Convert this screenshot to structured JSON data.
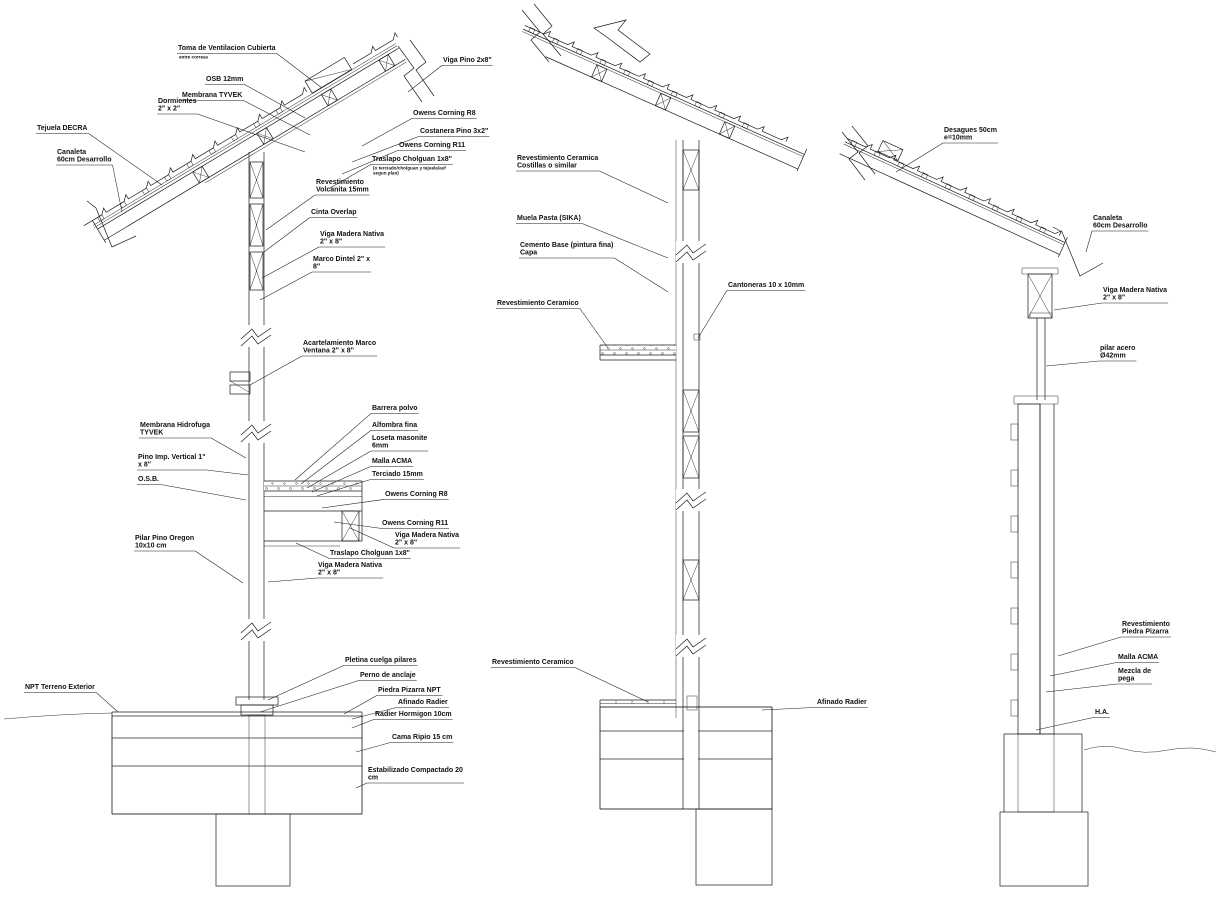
{
  "drawing": {
    "type": "cad-construction-section-details",
    "background_color": "#ffffff",
    "line_color": "#1b1b1b",
    "sections": [
      "left-wall-roof-section",
      "middle-wall-section",
      "right-pillar-section"
    ]
  },
  "annotations": {
    "left_section": [
      {
        "name": "toma-ventilacion-cubierta",
        "lines": [
          "Toma de Ventilacion Cubierta"
        ],
        "sub": [
          "entre correas"
        ],
        "x": 178,
        "y": 50,
        "tx": 322,
        "ty": 88
      },
      {
        "name": "osb-12mm",
        "lines": [
          "OSB 12mm"
        ],
        "x": 206,
        "y": 81,
        "tx": 305,
        "ty": 118
      },
      {
        "name": "membrana-tyvek",
        "lines": [
          "Membrana TYVEK"
        ],
        "x": 182,
        "y": 97,
        "tx": 310,
        "ty": 135
      },
      {
        "name": "dormientes-2x2",
        "lines": [
          "Dormientes",
          "2\" x 2\""
        ],
        "x": 158,
        "y": 103,
        "tx": 305,
        "ty": 152
      },
      {
        "name": "tejuela-decra",
        "lines": [
          "Tejuela DECRA"
        ],
        "x": 37,
        "y": 130,
        "tx": 162,
        "ty": 185
      },
      {
        "name": "canaleta-60cm",
        "lines": [
          "Canaleta",
          "60cm Desarrollo"
        ],
        "x": 57,
        "y": 154,
        "tx": 122,
        "ty": 212
      },
      {
        "name": "viga-pino-2x8",
        "lines": [
          "Viga Pino 2x8\""
        ],
        "x": 443,
        "y": 62,
        "tx": 408,
        "ty": 92
      },
      {
        "name": "owens-corning-r8-roof",
        "lines": [
          "Owens Corning R8"
        ],
        "x": 413,
        "y": 115,
        "tx": 362,
        "ty": 146
      },
      {
        "name": "costanera-pino-3x2",
        "lines": [
          "Costanera Pino 3x2\""
        ],
        "x": 420,
        "y": 133,
        "tx": 352,
        "ty": 162
      },
      {
        "name": "owens-corning-r11-roof",
        "lines": [
          "Owens Corning R11"
        ],
        "x": 399,
        "y": 147,
        "tx": 342,
        "ty": 174
      },
      {
        "name": "traslapo-cholguan-roof",
        "lines": [
          "Traslapo Cholguan 1x8\""
        ],
        "sub": [
          "(o terciado/cholguan y tejuela/asf",
          "segun plan)"
        ],
        "x": 372,
        "y": 161,
        "tx": 330,
        "ty": 188
      },
      {
        "name": "revestimiento-volcanita-15mm",
        "lines": [
          "Revestimiento",
          "Volcanita 15mm"
        ],
        "x": 316,
        "y": 184,
        "tx": 266,
        "ty": 230
      },
      {
        "name": "cinta-overlap",
        "lines": [
          "Cinta Overlap"
        ],
        "x": 311,
        "y": 214,
        "tx": 264,
        "ty": 252
      },
      {
        "name": "viga-madera-nativa-roof",
        "lines": [
          "Viga Madera Nativa",
          "2\" x 8\""
        ],
        "x": 320,
        "y": 236,
        "tx": 262,
        "ty": 278
      },
      {
        "name": "marco-dintel-2x8",
        "lines": [
          "Marco Dintel 2\" x",
          "8\""
        ],
        "x": 313,
        "y": 261,
        "tx": 260,
        "ty": 300
      },
      {
        "name": "acartelamiento-marco-ventana",
        "lines": [
          "Acartelamiento Marco",
          "Ventana 2\" x 8\""
        ],
        "x": 303,
        "y": 345,
        "tx": 250,
        "ty": 385
      },
      {
        "name": "membrana-hidrofuga-tyvek",
        "lines": [
          "Membrana Hidrofuga",
          "TYVEK"
        ],
        "x": 140,
        "y": 427,
        "tx": 246,
        "ty": 458
      },
      {
        "name": "pino-imp-vertical-1x8",
        "lines": [
          "Pino Imp. Vertical 1\"",
          "x 8\""
        ],
        "x": 138,
        "y": 459,
        "tx": 248,
        "ty": 475
      },
      {
        "name": "osb",
        "lines": [
          "O.S.B."
        ],
        "x": 138,
        "y": 481,
        "tx": 246,
        "ty": 500
      },
      {
        "name": "pilar-pino-oregon",
        "lines": [
          "Pilar Pino Oregon",
          "10x10 cm"
        ],
        "x": 135,
        "y": 540,
        "tx": 243,
        "ty": 583
      },
      {
        "name": "barrera-polvo",
        "lines": [
          "Barrera polvo"
        ],
        "x": 372,
        "y": 410,
        "tx": 295,
        "ty": 480
      },
      {
        "name": "alfombra-fina",
        "lines": [
          "Alfombra fina"
        ],
        "x": 372,
        "y": 427,
        "tx": 301,
        "ty": 484
      },
      {
        "name": "loseta-masonite-6mm",
        "lines": [
          "Loseta masonite",
          "6mm"
        ],
        "x": 372,
        "y": 440,
        "tx": 307,
        "ty": 488
      },
      {
        "name": "malla-acma-piso",
        "lines": [
          "Malla ACMA"
        ],
        "x": 372,
        "y": 463,
        "tx": 312,
        "ty": 492
      },
      {
        "name": "terciado-15mm",
        "lines": [
          "Terciado 15mm"
        ],
        "x": 372,
        "y": 476,
        "tx": 317,
        "ty": 496
      },
      {
        "name": "owens-corning-r8-piso",
        "lines": [
          "Owens Corning R8"
        ],
        "x": 385,
        "y": 496,
        "tx": 322,
        "ty": 508
      },
      {
        "name": "owens-corning-r11-piso",
        "lines": [
          "Owens Corning R11"
        ],
        "x": 382,
        "y": 525,
        "tx": 334,
        "ty": 522
      },
      {
        "name": "viga-madera-nativa-piso",
        "lines": [
          "Viga Madera Nativa",
          "2\" x 8\""
        ],
        "x": 395,
        "y": 537,
        "tx": 350,
        "ty": 528
      },
      {
        "name": "traslapo-cholguan-piso",
        "lines": [
          "Traslapo Cholguan 1x8\""
        ],
        "x": 330,
        "y": 555,
        "tx": 296,
        "ty": 543
      },
      {
        "name": "viga-madera-nativa-muro",
        "lines": [
          "Viga Madera Nativa",
          "2\" x 8\""
        ],
        "x": 318,
        "y": 567,
        "tx": 268,
        "ty": 582
      },
      {
        "name": "pletina-cuelga-pilares",
        "lines": [
          "Pletina cuelga pilares"
        ],
        "x": 345,
        "y": 662,
        "tx": 268,
        "ty": 700
      },
      {
        "name": "perno-de-anclaje",
        "lines": [
          "Perno de anclaje"
        ],
        "x": 360,
        "y": 677,
        "tx": 260,
        "ty": 712
      },
      {
        "name": "piedra-pizarra-npt",
        "lines": [
          "Piedra Pizarra NPT"
        ],
        "x": 378,
        "y": 692,
        "tx": 344,
        "ty": 714
      },
      {
        "name": "afinado-radier-left",
        "lines": [
          "Afinado Radier"
        ],
        "x": 398,
        "y": 704,
        "tx": 352,
        "ty": 719
      },
      {
        "name": "radier-hormigon-10cm",
        "lines": [
          "Radier Hormigon 10cm"
        ],
        "x": 375,
        "y": 716,
        "tx": 352,
        "ty": 728
      },
      {
        "name": "cama-ripio-15cm",
        "lines": [
          "Cama Ripio 15 cm"
        ],
        "x": 392,
        "y": 739,
        "tx": 356,
        "ty": 752
      },
      {
        "name": "estabilizado-compactado-20cm",
        "lines": [
          "Estabilizado Compactado 20",
          "cm"
        ],
        "x": 368,
        "y": 772,
        "tx": 356,
        "ty": 788
      },
      {
        "name": "npt-terreno-exterior",
        "lines": [
          "NPT Terreno Exterior"
        ],
        "x": 25,
        "y": 689,
        "tx": 118,
        "ty": 712
      }
    ],
    "middle_section": [
      {
        "name": "revestimiento-ceramica-costillas",
        "lines": [
          "Revestimiento Ceramica",
          "Costillas o similar"
        ],
        "x": 517,
        "y": 160,
        "tx": 668,
        "ty": 203
      },
      {
        "name": "muela-pasta-sika",
        "lines": [
          "Muela Pasta (SIKA)"
        ],
        "x": 517,
        "y": 220,
        "tx": 668,
        "ty": 258
      },
      {
        "name": "cemento-base-pintura-fina",
        "lines": [
          "Cemento Base (pintura fina)",
          "Capa"
        ],
        "x": 520,
        "y": 247,
        "tx": 668,
        "ty": 292
      },
      {
        "name": "revestimiento-ceramico-muro",
        "lines": [
          "Revestimiento Ceramico"
        ],
        "x": 497,
        "y": 305,
        "tx": 608,
        "ty": 348
      },
      {
        "name": "cantoneras-10x10",
        "lines": [
          "Cantoneras 10 x 10mm"
        ],
        "x": 728,
        "y": 287,
        "tx": 698,
        "ty": 338
      },
      {
        "name": "revestimiento-ceramico-piso",
        "lines": [
          "Revestimiento Ceramico"
        ],
        "x": 492,
        "y": 664,
        "tx": 648,
        "ty": 702
      },
      {
        "name": "afinado-radier-mid",
        "lines": [
          "Afinado Radier"
        ],
        "x": 817,
        "y": 704,
        "tx": 762,
        "ty": 710
      }
    ],
    "right_section": [
      {
        "name": "desagues-50cm",
        "lines": [
          "Desagues 50cm",
          "e=10mm"
        ],
        "x": 944,
        "y": 132,
        "tx": 896,
        "ty": 172
      },
      {
        "name": "canaleta-60cm-right",
        "lines": [
          "Canaleta",
          "60cm Desarrollo"
        ],
        "x": 1093,
        "y": 220,
        "tx": 1086,
        "ty": 252
      },
      {
        "name": "viga-madera-nativa-right",
        "lines": [
          "Viga Madera Nativa",
          "2\" x 8\""
        ],
        "x": 1103,
        "y": 292,
        "tx": 1054,
        "ty": 310
      },
      {
        "name": "pilar-acero-42mm",
        "lines": [
          "pilar acero",
          "Ø42mm"
        ],
        "x": 1100,
        "y": 350,
        "tx": 1046,
        "ty": 366
      },
      {
        "name": "revestimiento-piedra-pizarra",
        "lines": [
          "Revestimiento",
          "Piedra Pizarra"
        ],
        "x": 1122,
        "y": 626,
        "tx": 1058,
        "ty": 656
      },
      {
        "name": "malla-acma-right",
        "lines": [
          "Malla ACMA"
        ],
        "x": 1118,
        "y": 659,
        "tx": 1050,
        "ty": 676
      },
      {
        "name": "mezcla-de-pega",
        "lines": [
          "Mezcla de",
          "pega"
        ],
        "x": 1118,
        "y": 673,
        "tx": 1046,
        "ty": 692
      },
      {
        "name": "hormigon-armado",
        "lines": [
          "H.A."
        ],
        "x": 1095,
        "y": 714,
        "tx": 1036,
        "ty": 730
      }
    ]
  }
}
